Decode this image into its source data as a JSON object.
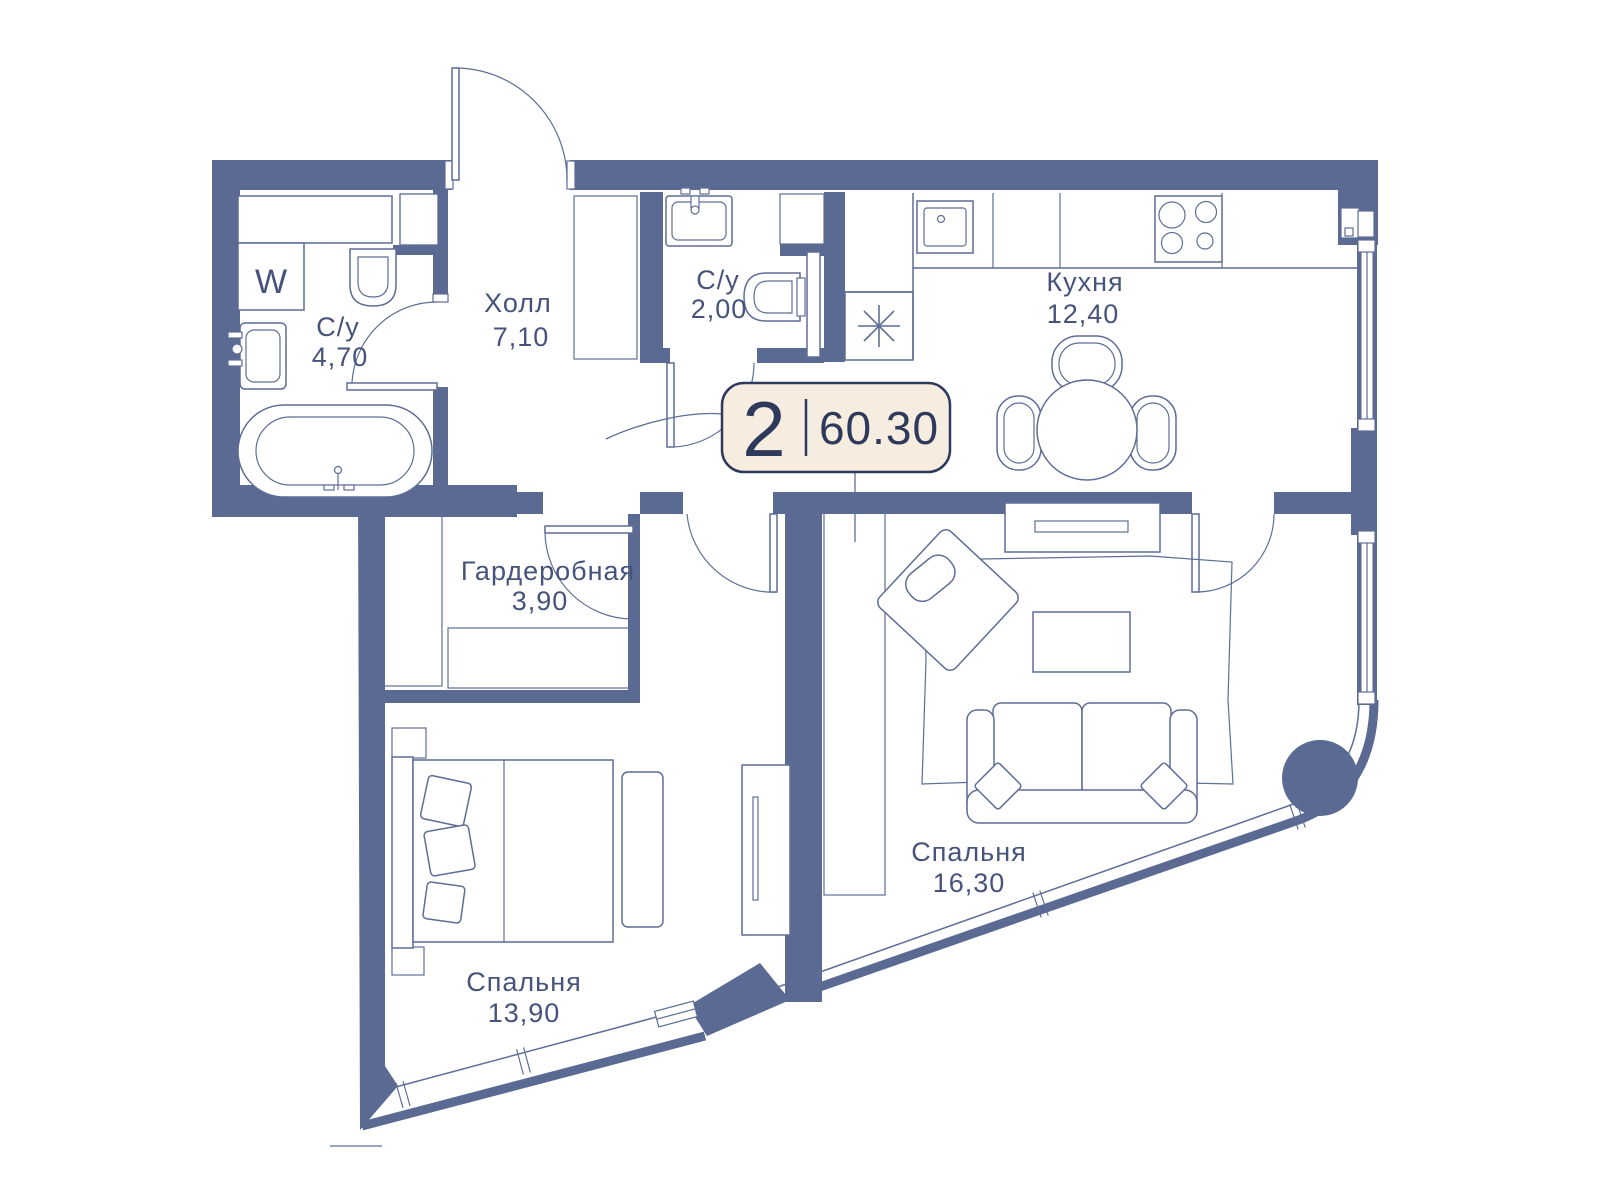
{
  "badge": {
    "rooms_count": "2",
    "area": "60.30"
  },
  "rooms": [
    {
      "id": "bathroom-main",
      "name": "С/у",
      "area": "4,70"
    },
    {
      "id": "hall",
      "name": "Холл",
      "area": "7,10"
    },
    {
      "id": "bathroom-guest",
      "name": "С/у",
      "area": "2,00"
    },
    {
      "id": "kitchen",
      "name": "Кухня",
      "area": "12,40"
    },
    {
      "id": "wardrobe-room",
      "name": "Гардеробная",
      "area": "3,90"
    },
    {
      "id": "bedroom-1",
      "name": "Спальня",
      "area": "13,90"
    },
    {
      "id": "bedroom-2",
      "name": "Спальня",
      "area": "16,30"
    }
  ],
  "labels": {
    "washer": "W"
  },
  "colors": {
    "wall": "#5B6A92",
    "line": "#5F6D97",
    "text": "#46537B",
    "badge-bg": "#F6EDE0",
    "badge-border": "#2E3A5C",
    "badge-text": "#2E3A5C"
  }
}
